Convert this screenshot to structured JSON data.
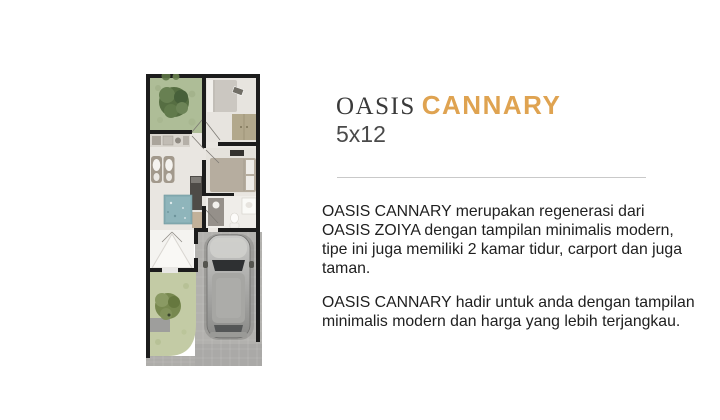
{
  "header": {
    "brand": "OASIS",
    "model": "CANNARY",
    "size_label": "5x12"
  },
  "colors": {
    "brand_text": "#3a3a3a",
    "accent_gold": "#dfa351",
    "size_text": "#4a4a4a",
    "body_text": "#202020",
    "divider": "#c9c9c9",
    "garden_green": "#aebd97",
    "pond_blue": "#87aeb4",
    "paving_gray": "#b2b1ae",
    "wall_black": "#1c1c1c"
  },
  "description": {
    "paragraph_1_lines": [
      "OASIS CANNARY merupakan regenerasi dari",
      "OASIS ZOIYA dengan tampilan minimalis modern,",
      "tipe ini juga memiliki 2 kamar tidur, carport dan juga",
      "taman."
    ],
    "paragraph_2_lines": [
      "OASIS CANNARY hadir untuk anda dengan tampilan",
      "minimalis modern dan harga yang lebih terjangkau."
    ]
  },
  "floorplan": {
    "features": [
      "back-garden-tree",
      "bedroom-1-bed",
      "wardrobe",
      "kitchen-counter",
      "twin-wash-basins",
      "pond",
      "bedroom-2-bed",
      "bathroom-toilet",
      "entrance-canopy",
      "carport-car",
      "front-garden-tree",
      "paved-driveway"
    ]
  }
}
